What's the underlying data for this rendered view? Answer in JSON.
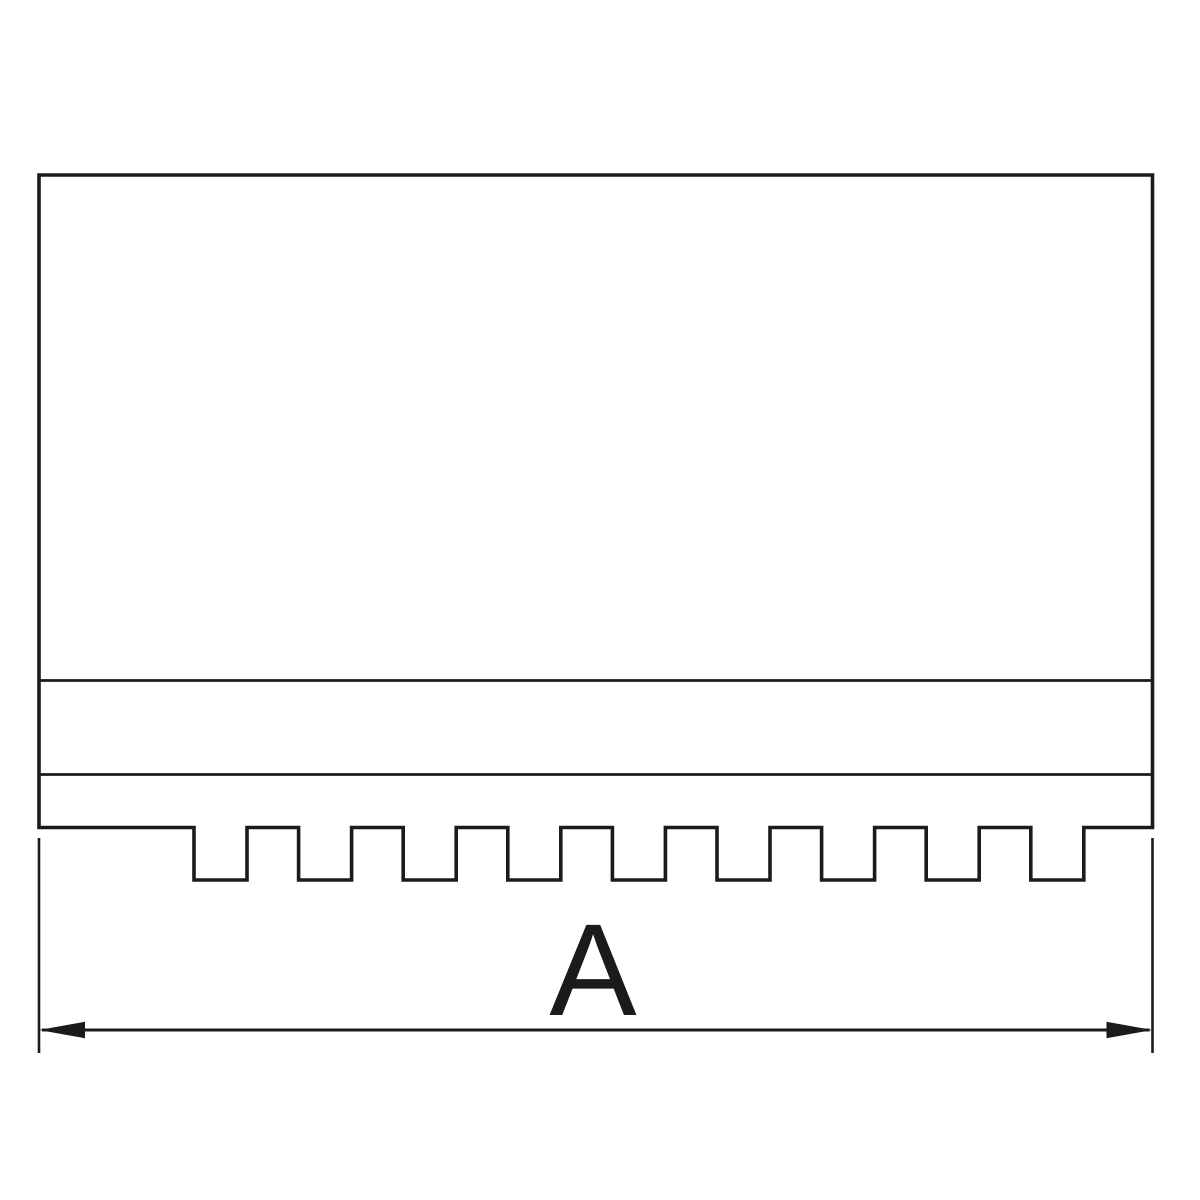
{
  "drawing": {
    "dimension_label": "A",
    "serration_notch_count": 9,
    "colors": {
      "line": "#1b1b1b",
      "background": "#ffffff"
    }
  }
}
